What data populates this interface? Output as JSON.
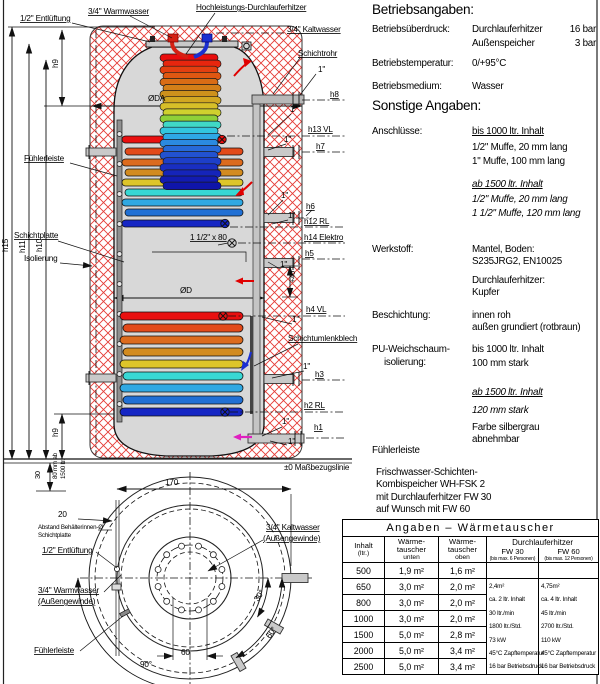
{
  "colors": {
    "hatch": "#e43b36",
    "tank": "#d8d8d8",
    "pipe": "#bdbdbd",
    "hot": "#e90f0f",
    "cold": "#1526c4",
    "magenta": "#e020c0"
  },
  "front": {
    "entlueftung": "1/2\" Entlüftung",
    "warmwasser": "3/4\" Warmwasser",
    "hochleistung": "Hochleistungs-Durchlauferhitzer",
    "kaltwasser": "3/4\" Kaltwasser",
    "schichtrohr": "Schichtrohr",
    "oda": "ØDA",
    "od": "ØD",
    "fuehlerleiste": "Fühlerleiste",
    "schichtplatte": "Schichtplatte",
    "isolierung": "Isolierung",
    "umlenkblech": "Schichtumlenkblech",
    "elektro_muffe": "1 1/2\" x 80",
    "plus40": "+40",
    "massbezug": "±0 Maßbezugslinie",
    "inch1": "1\"",
    "h1": "h1",
    "h2": "h2 RL",
    "h3": "h3",
    "h4": "h4 VL",
    "h5": "h5",
    "h6": "h6",
    "h7": "h7",
    "h8": "h8",
    "h9": "h9",
    "h10": "h10",
    "h11": "h11",
    "h12": "h12 RL",
    "h13": "h13 VL",
    "h14": "h14 Elektro",
    "h15": "h15",
    "dim30": "30",
    "dim80a": "80 mm ab",
    "dim80b": "1500 ltr."
  },
  "top_view": {
    "dim170": "170",
    "dim20": "20",
    "dim60": "60",
    "ang30": "30°",
    "ang60": "60°",
    "ang90": "90°",
    "abstand1": "Abstand Behälterinnen-Ø",
    "abstand2": "Schichtplatte",
    "entlueftung": "1/2\" Entlüftung",
    "warmwasser1": "3/4\" Warmwasser",
    "warmwasser2": "(Außengewinde)",
    "kaltwasser1": "3/4\" Kaltwasser",
    "kaltwasser2": "(Außengewinde)",
    "fuehlerleiste": "Fühlerleiste"
  },
  "specs": {
    "title1": "Betriebsangaben:",
    "ueberdruck_label": "Betriebsüberdruck:",
    "ueberdruck_v1": "Durchlauferhitzer",
    "ueberdruck_v1b": "16 bar",
    "ueberdruck_v2": "Außenspeicher",
    "ueberdruck_v2b": "3 bar",
    "temperatur_label": "Betriebstemperatur:",
    "temperatur_value": "0/+95°C",
    "medium_label": "Betriebsmedium:",
    "medium_value": "Wasser",
    "title2": "Sonstige Angaben:",
    "anschluesse_label": "Anschlüsse:",
    "ans_1": "bis 1000 ltr. Inhalt",
    "ans_2": "1/2\" Muffe, 20 mm lang",
    "ans_3": "1\" Muffe, 100 mm lang",
    "ans_4": "ab 1500 ltr. Inhalt",
    "ans_5": "1/2\" Muffe, 20 mm lang",
    "ans_6": "1 1/2\" Muffe, 120 mm lang",
    "werkstoff_label": "Werkstoff:",
    "werk_1": "Mantel, Boden:",
    "werk_2": "S235JRG2, EN10025",
    "werk_3": "Durchlauferhitzer:",
    "werk_4": "Kupfer",
    "beschichtung_label": "Beschichtung:",
    "besch_1": "innen roh",
    "besch_2": "außen grundiert (rotbraun)",
    "pu_label1": "PU-Weichschaum-",
    "pu_label2": "isolierung:",
    "pu_1": "bis 1000 ltr. Inhalt",
    "pu_2": "100 mm stark",
    "pu_3": "ab 1500 ltr. Inhalt",
    "pu_4": "120 mm stark",
    "pu_5": "Farbe silbergrau",
    "pu_6": "abnehmbar",
    "fuehlerleiste_note": "Fühlerleiste",
    "product_1": "Frischwasser-Schichten-",
    "product_2": "Kombispeicher WH-FSK 2",
    "product_3": "mit Durchlauferhitzer FW 30",
    "product_4": "auf Wunsch mit FW 60"
  },
  "table": {
    "title": "Angaben – Wärmetauscher",
    "col_inhalt_1": "Inhalt",
    "col_inhalt_2": "(ltr.)",
    "col_unten_1": "Wärme-",
    "col_unten_2": "tauscher",
    "col_unten_3": "unten",
    "col_oben_1": "Wärme-",
    "col_oben_2": "tauscher",
    "col_oben_3": "oben",
    "col_dle": "Durchlauferhitzer",
    "col_fw30": "FW 30",
    "col_fw30_sub": "(bis max. 6 Personen)",
    "col_fw60": "FW 60",
    "col_fw60_sub": "(bis max. 12 Personen)",
    "rows": [
      {
        "inhalt": "500",
        "unten": "1,9 m²",
        "oben": "1,6 m²"
      },
      {
        "inhalt": "650",
        "unten": "3,0 m²",
        "oben": "2,0 m²"
      },
      {
        "inhalt": "800",
        "unten": "3,0 m²",
        "oben": "2,0 m²"
      },
      {
        "inhalt": "1000",
        "unten": "3,0 m²",
        "oben": "2,0 m²"
      },
      {
        "inhalt": "1500",
        "unten": "5,0 m²",
        "oben": "2,8 m²"
      },
      {
        "inhalt": "2000",
        "unten": "5,0 m²",
        "oben": "3,4 m²"
      },
      {
        "inhalt": "2500",
        "unten": "5,0 m²",
        "oben": "3,4 m²"
      }
    ],
    "fw30_lines": [
      "2,4m²",
      "ca. 2 ltr. Inhalt",
      "30 ltr./min",
      "1800 ltr./Std.",
      "73 kW",
      "45°C Zapftemperatur",
      "16 bar Betriebsdruck"
    ],
    "fw60_lines": [
      "4,75m²",
      "ca. 4 ltr. Inhalt",
      "45 ltr./min",
      "2700 ltr./Std.",
      "110 kW",
      "45°C Zapftemperatur",
      "16 bar Betriebsdruck"
    ]
  }
}
